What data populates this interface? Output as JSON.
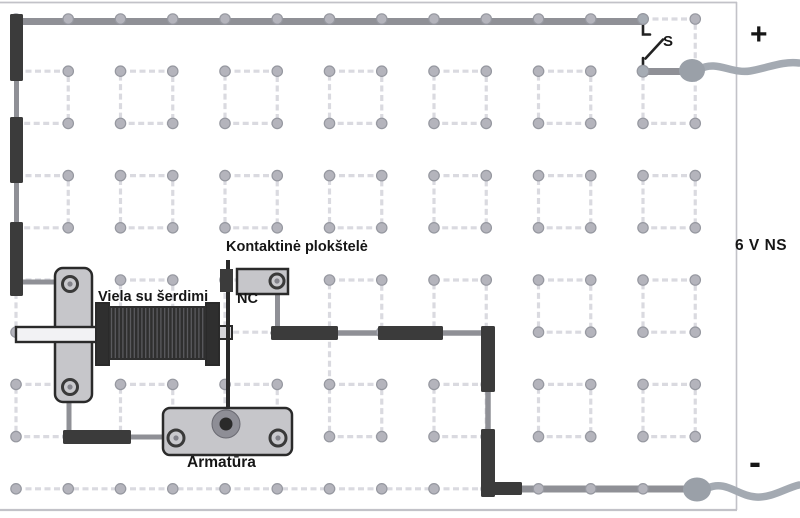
{
  "labels": {
    "contact_plate": "Kontaktinė plokštelė",
    "nc": "NC",
    "coil": "Viela su šerdimi",
    "armature": "Armatūra",
    "switch": "S",
    "positive": "+",
    "battery": "6 V NS",
    "negative": "-"
  },
  "colors": {
    "background": "#ffffff",
    "board_edge": "#c2c2c8",
    "grid_line": "#dadae0",
    "peg_fill": "#b4b4bc",
    "peg_ring": "#9698a0",
    "wire_gray": "#8f9096",
    "wire_flex": "#a4aab2",
    "terminal_blob": "#9aa0a8",
    "dark_segment": "#3b3b3b",
    "component_fill": "#c6c6ca",
    "component_edge": "#2a2a2a",
    "core_fill": "#f2f2f4",
    "core_stub_fill": "#d5d5d9",
    "coil_body": "#2f2f2f",
    "coil_stripe": "#5a5a5e",
    "screw_fill": "#c9c9cd",
    "screw_edge": "#3a3a3a",
    "screw_dot": "#82828a",
    "pivot_outer": "#8e8e96",
    "pivot_inner": "#2a2a2a",
    "switch_stroke": "#222222",
    "text": "#161616"
  }
}
